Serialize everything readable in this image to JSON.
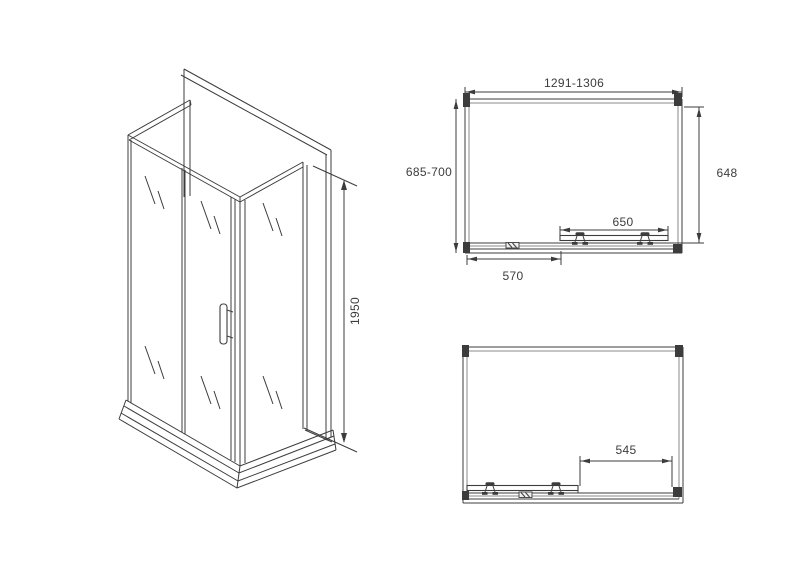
{
  "colors": {
    "background": "#ffffff",
    "line": "#3c3c3c",
    "line_light": "#8a8a8a"
  },
  "drawing": {
    "type": "technical-dimension-drawing",
    "subject": "corner shower enclosure with sliding doors",
    "views": {
      "isometric": {
        "dims": {
          "height": "1950"
        }
      },
      "plan_top": {
        "dims": {
          "width_range": "1291-1306",
          "depth_range": "685-700",
          "side_depth": "648",
          "door_width": "650",
          "left_section": "570"
        }
      },
      "plan_bottom": {
        "dims": {
          "opening_width": "545"
        }
      }
    }
  }
}
